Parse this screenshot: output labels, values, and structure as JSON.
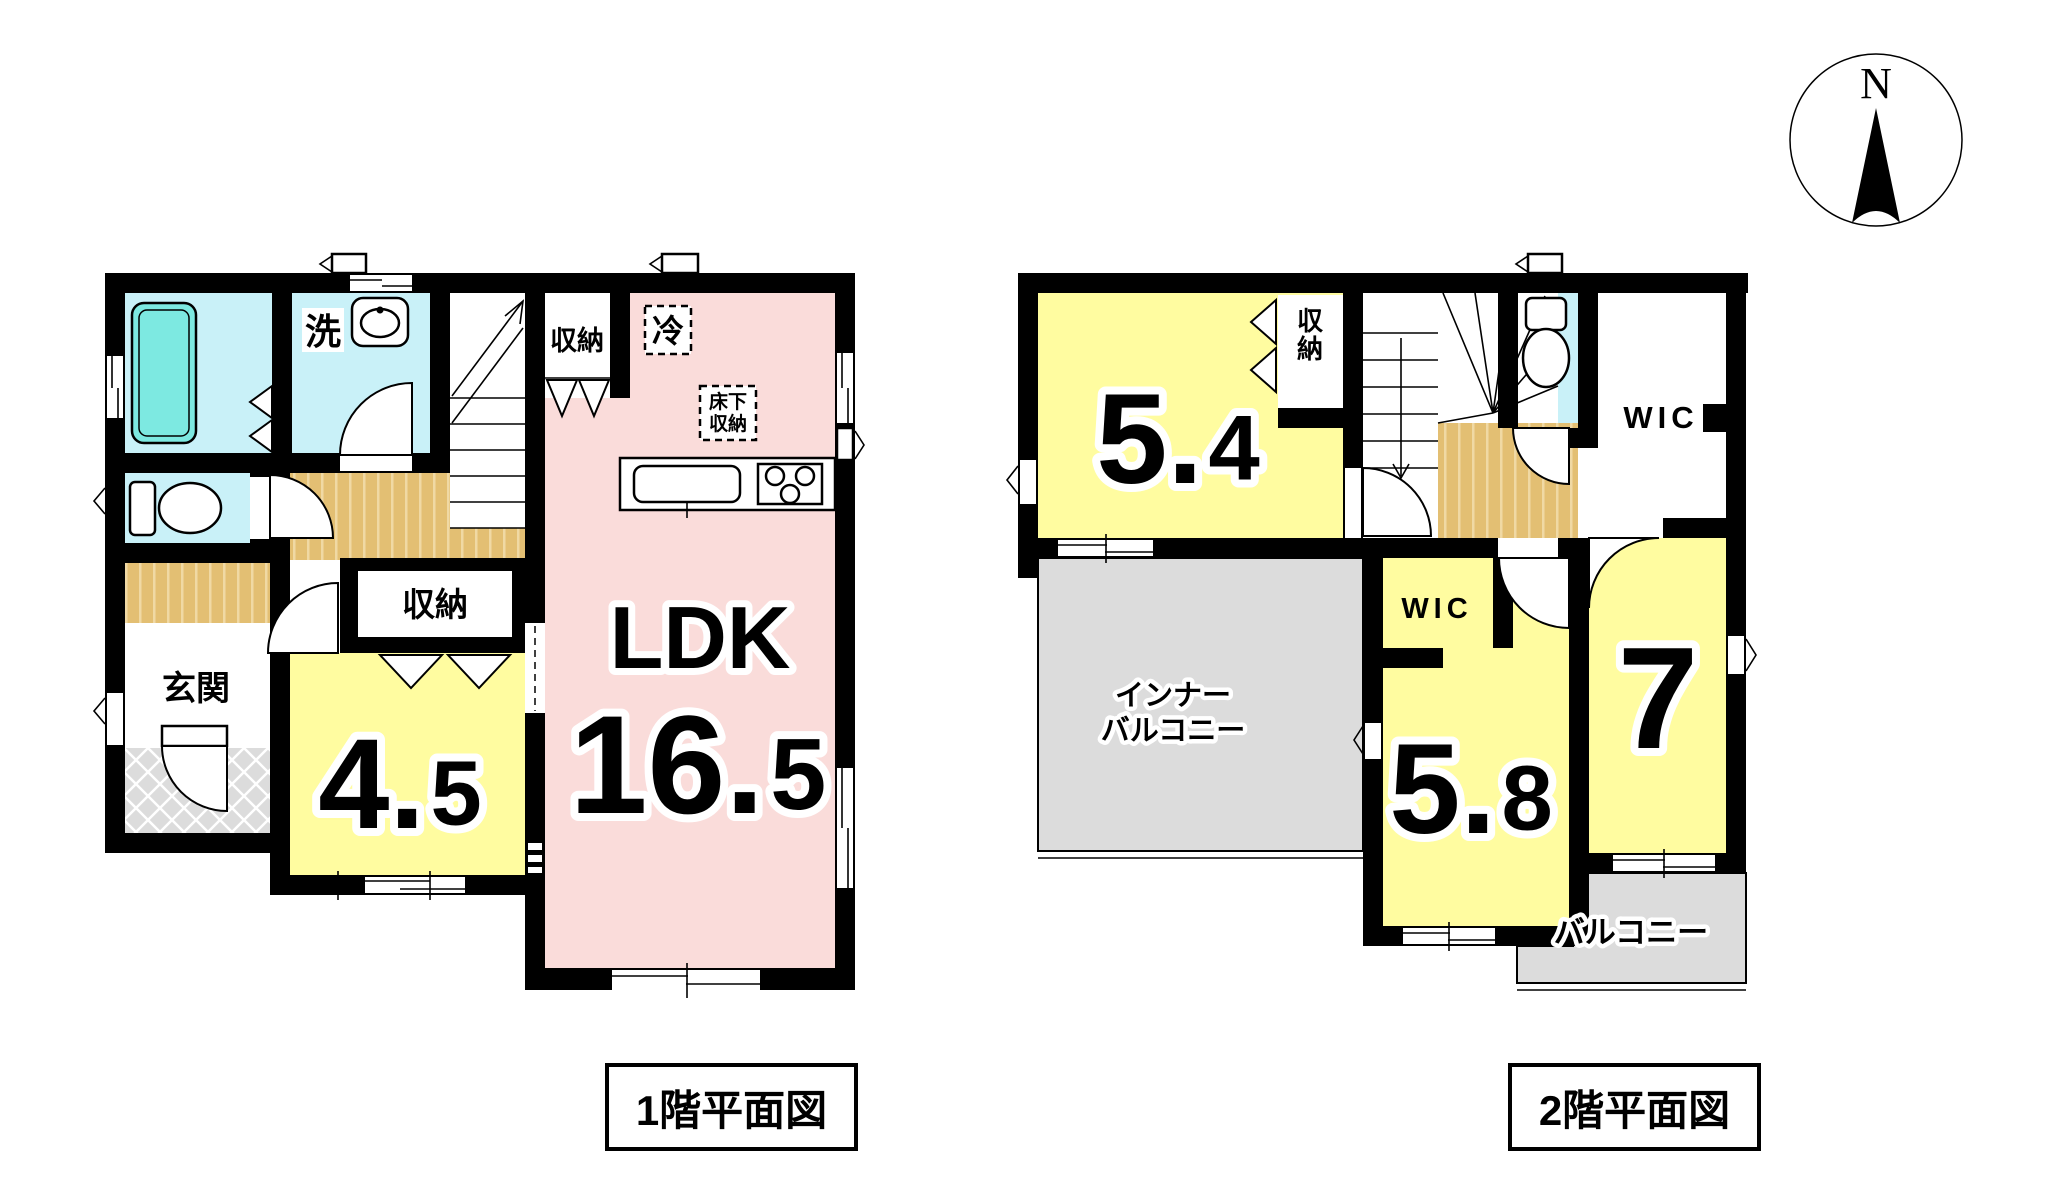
{
  "compass": {
    "north_label": "N"
  },
  "colors": {
    "yellow": "#fffca0",
    "pink": "#fadcda",
    "cyan": "#c9f1f8",
    "tub": "#7de9e1",
    "wood": "#e3bf73",
    "wood_stripe": "#f0d9a4",
    "gray": "#dcdcdc"
  },
  "floor1": {
    "title": "1階平面図",
    "ldk": {
      "name": "LDK",
      "size": "16.5"
    },
    "room45": {
      "size": "4.5"
    },
    "entrance": {
      "label": "玄関"
    },
    "laundry": {
      "label": "洗"
    },
    "closet_top": {
      "label": "収納"
    },
    "closet_mid": {
      "label": "収納"
    },
    "fridge": {
      "label": "冷"
    },
    "underfloor_storage": {
      "lines": [
        "床下",
        "収納"
      ]
    }
  },
  "floor2": {
    "title": "2階平面図",
    "room54": {
      "size": "5.4"
    },
    "room58": {
      "size": "5.8"
    },
    "room7": {
      "size": "7"
    },
    "closet": {
      "label": "収納"
    },
    "wic_top": {
      "label": "WIC"
    },
    "wic_mid": {
      "label": "WIC"
    },
    "inner_balcony": {
      "lines": [
        "インナー",
        "バルコニー"
      ]
    },
    "balcony": {
      "label": "バルコニー"
    }
  }
}
